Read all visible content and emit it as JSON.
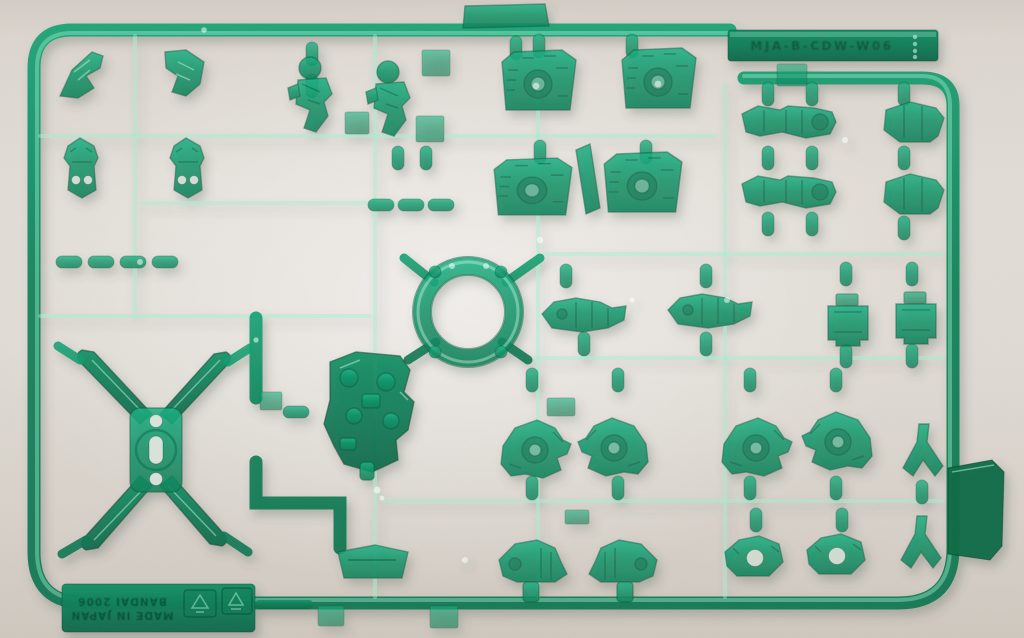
{
  "runner": {
    "material": "clear-green-plastic",
    "top_tab": {
      "emboss_code": "MJA-B-CDW-W06",
      "ejector_dots": 4
    },
    "bottom_tab": {
      "maker_line": "BANDAI 2006",
      "origin_line": "MADE IN JAPAN",
      "stamps": [
        "recycle-mark",
        "recycle-mark"
      ]
    },
    "colors": {
      "plastic_light": "#17b283",
      "plastic_mid": "#0e9468",
      "plastic_dark": "#0a7a52",
      "plastic_deep": "#076247",
      "solid_tab": "#0a6b45",
      "highlight": "#9cead0",
      "surface": "#e0dbd4",
      "surface_bright": "#edebe7",
      "surface_shadow": "#cfc8bf"
    }
  }
}
